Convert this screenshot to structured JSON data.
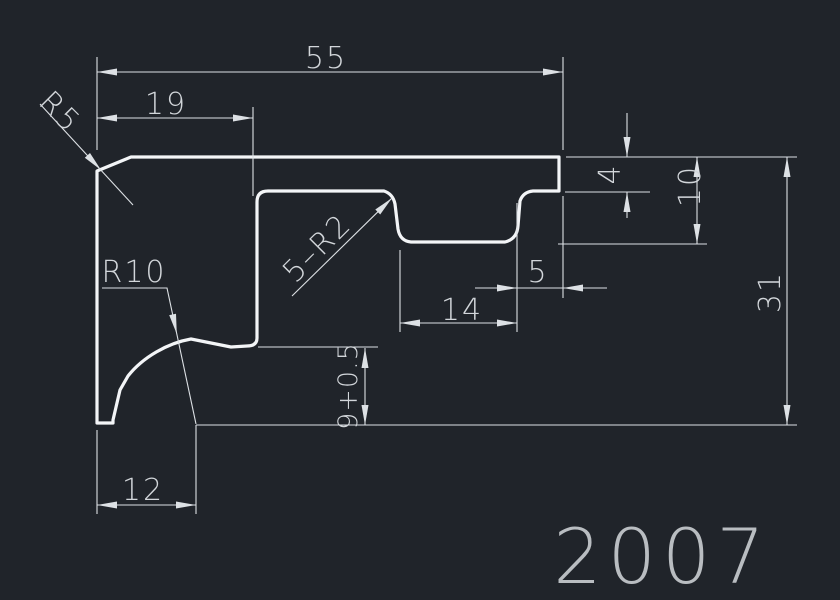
{
  "colors": {
    "background": "#20242a",
    "profile_line": "#f3f5f7",
    "dim_line": "#dde1e5",
    "dim_text": "#d2d6da",
    "title_text": "#b9bdc1"
  },
  "title_block": {
    "drawing_number": "2007"
  },
  "dimensions": {
    "overall_width": "55",
    "top_left_offset": "19",
    "corner_radius_top_left": "R5",
    "corner_radius_bottom_left": "R10",
    "fillet_callout": "5–R2",
    "right_step_depth": "4",
    "groove_depth": "10",
    "overall_height": "31",
    "right_lip_width": "5",
    "groove_width": "14",
    "leg_height_tolerance": "9+0.5",
    "leg_width": "12"
  }
}
